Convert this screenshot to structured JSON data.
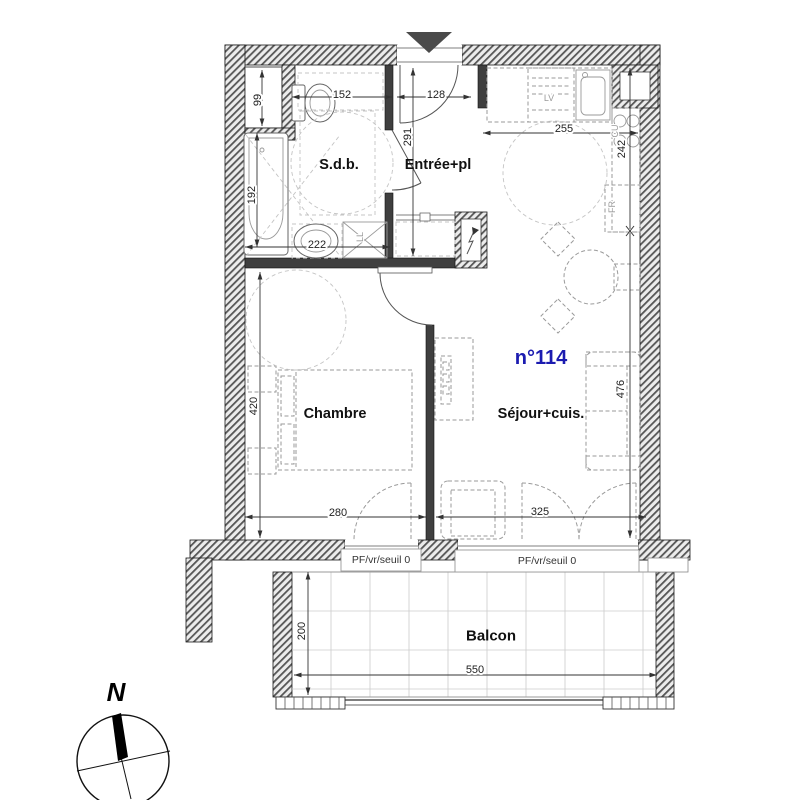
{
  "plan": {
    "unit": {
      "number": "n°114",
      "color": "#1b1bb0"
    },
    "rooms": {
      "bathroom": "S.d.b.",
      "entry": "Entrée+pl",
      "bedroom": "Chambre",
      "living": "Séjour+cuis.",
      "balcony": "Balcon"
    },
    "appliances": {
      "dishwasher": "LV",
      "cooktop": "CU",
      "fridge": "FR",
      "washer": "LL"
    },
    "windows": [
      {
        "label": "PF/vr/seuil 0"
      },
      {
        "label": "PF/vr/seuil 0"
      }
    ],
    "compass": {
      "north": "N"
    },
    "dimensions": {
      "duct_height": "99",
      "wc_width": "152",
      "entry_door_width": "128",
      "entry_depth": "291",
      "kitchen_width": "255",
      "kitchen_depth": "242",
      "bathtub_length": "192",
      "bathroom_width": "222",
      "bedroom_depth": "420",
      "bedroom_width": "280",
      "living_width": "325",
      "living_depth": "476",
      "balcony_width": "550",
      "balcony_depth": "200"
    }
  }
}
